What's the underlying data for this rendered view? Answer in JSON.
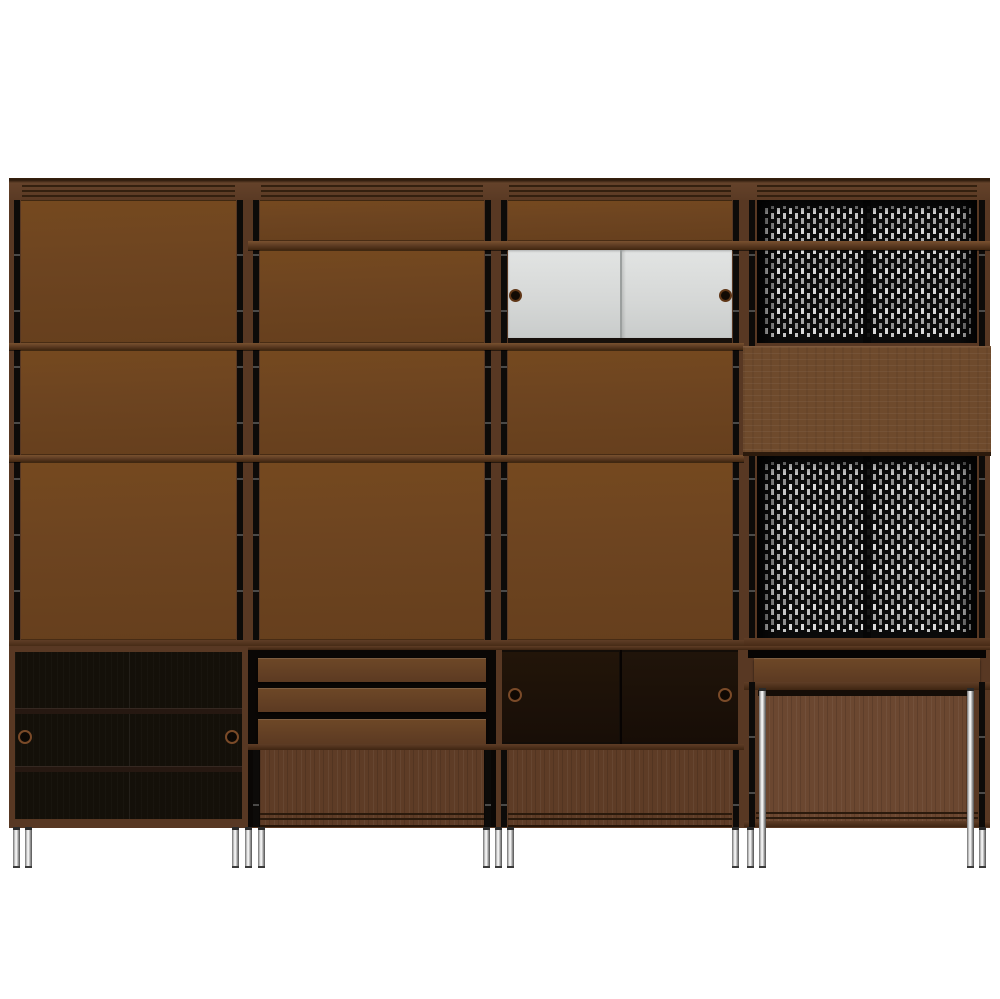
{
  "scene": {
    "type": "product-render",
    "object": "modular wall storage unit with four bays on chrome legs",
    "background_color": "#ffffff"
  },
  "colors": {
    "bg": "#ffffff",
    "panel": "#6d4420",
    "frame": "#583823",
    "frameLight": "#64422a",
    "groove": "#33200f",
    "track": "#0d0b09",
    "interior": "#141009",
    "doorWood": "#5e3c26",
    "drawer": "#5c3a22",
    "slab": "#6e4a2c",
    "white": "#d5d7d6",
    "knob": "#120a04",
    "ring": "#7a4a28",
    "perfBg": "#0a0a0a",
    "slotBright": "#d9d9d9",
    "slotDim": "#8f8f8f",
    "chrome": "#ebebeb"
  },
  "unit": {
    "bays": [
      {
        "name": "bay-1",
        "upper_sections": [
          "tall closed panel",
          "closed panel",
          "closed panel"
        ],
        "lower_cabinet": "dark sliding-door cabinet, 2 interior shelves, 2 ring pulls"
      },
      {
        "name": "bay-2",
        "upper_sections": [
          "short closed panel",
          "closed panel",
          "closed panel",
          "closed panel"
        ],
        "lower_cabinet": "3-drawer chest over wood sliding-door compartment"
      },
      {
        "name": "bay-3",
        "upper_sections": [
          "short closed panel",
          "white sliding-door cabinet with 2 recessed knobs",
          "closed panel",
          "closed panel"
        ],
        "lower_cabinet": "open dark sliding-door compartment with 2 ring pulls over wood sliding-door compartment"
      },
      {
        "name": "bay-4",
        "upper_sections": [
          "perforated metal panel with shelf rail",
          "fold-down desk panel",
          "perforated metal panel"
        ],
        "lower_cabinet": "single drawer over open desk bay with chrome front legs"
      }
    ],
    "hardware": {
      "ring_pull_count": 4,
      "white_door_knob_count": 2,
      "drawer_count": 4
    },
    "legs": {
      "finish": "chrome",
      "short_count": 11,
      "tall_count": 2
    }
  }
}
